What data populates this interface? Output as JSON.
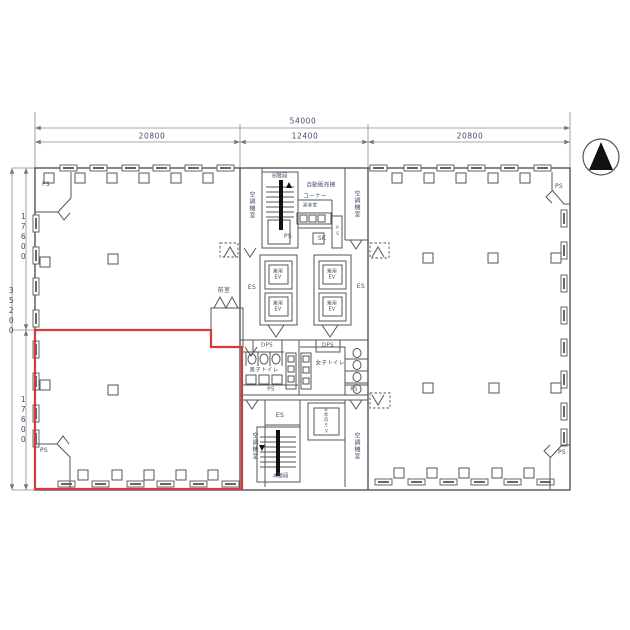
{
  "plan": {
    "dimensions": {
      "total_width": "54000",
      "left_bay": "20800",
      "center_bay": "12400",
      "right_bay": "20800",
      "total_depth": "35200",
      "upper_depth": "17600",
      "lower_depth": "17600"
    },
    "labels": {
      "ps": "PS",
      "dps": "DPS",
      "sk": "SK",
      "es": "ES",
      "ac_room": "空調機室",
      "stair_b": "B階段",
      "stair_a": "A階段",
      "vending_line1": "自動販売機",
      "vending_line2": "コーナー",
      "hot_water_room": "湯沸室",
      "anteroom": "前室",
      "mens_toilet": "男子トイレ",
      "womens_toilet": "女子トイレ",
      "passenger_ev_line1": "乗用",
      "passenger_ev_line2": "EV",
      "emergency_ev": "非常用EV"
    },
    "colors": {
      "wall_line": "#555555",
      "dimension_line": "#8a8a8a",
      "label_text": "#3f4e68",
      "highlight_outline": "#d43a3c",
      "north_arrow_fill": "#111111"
    }
  }
}
